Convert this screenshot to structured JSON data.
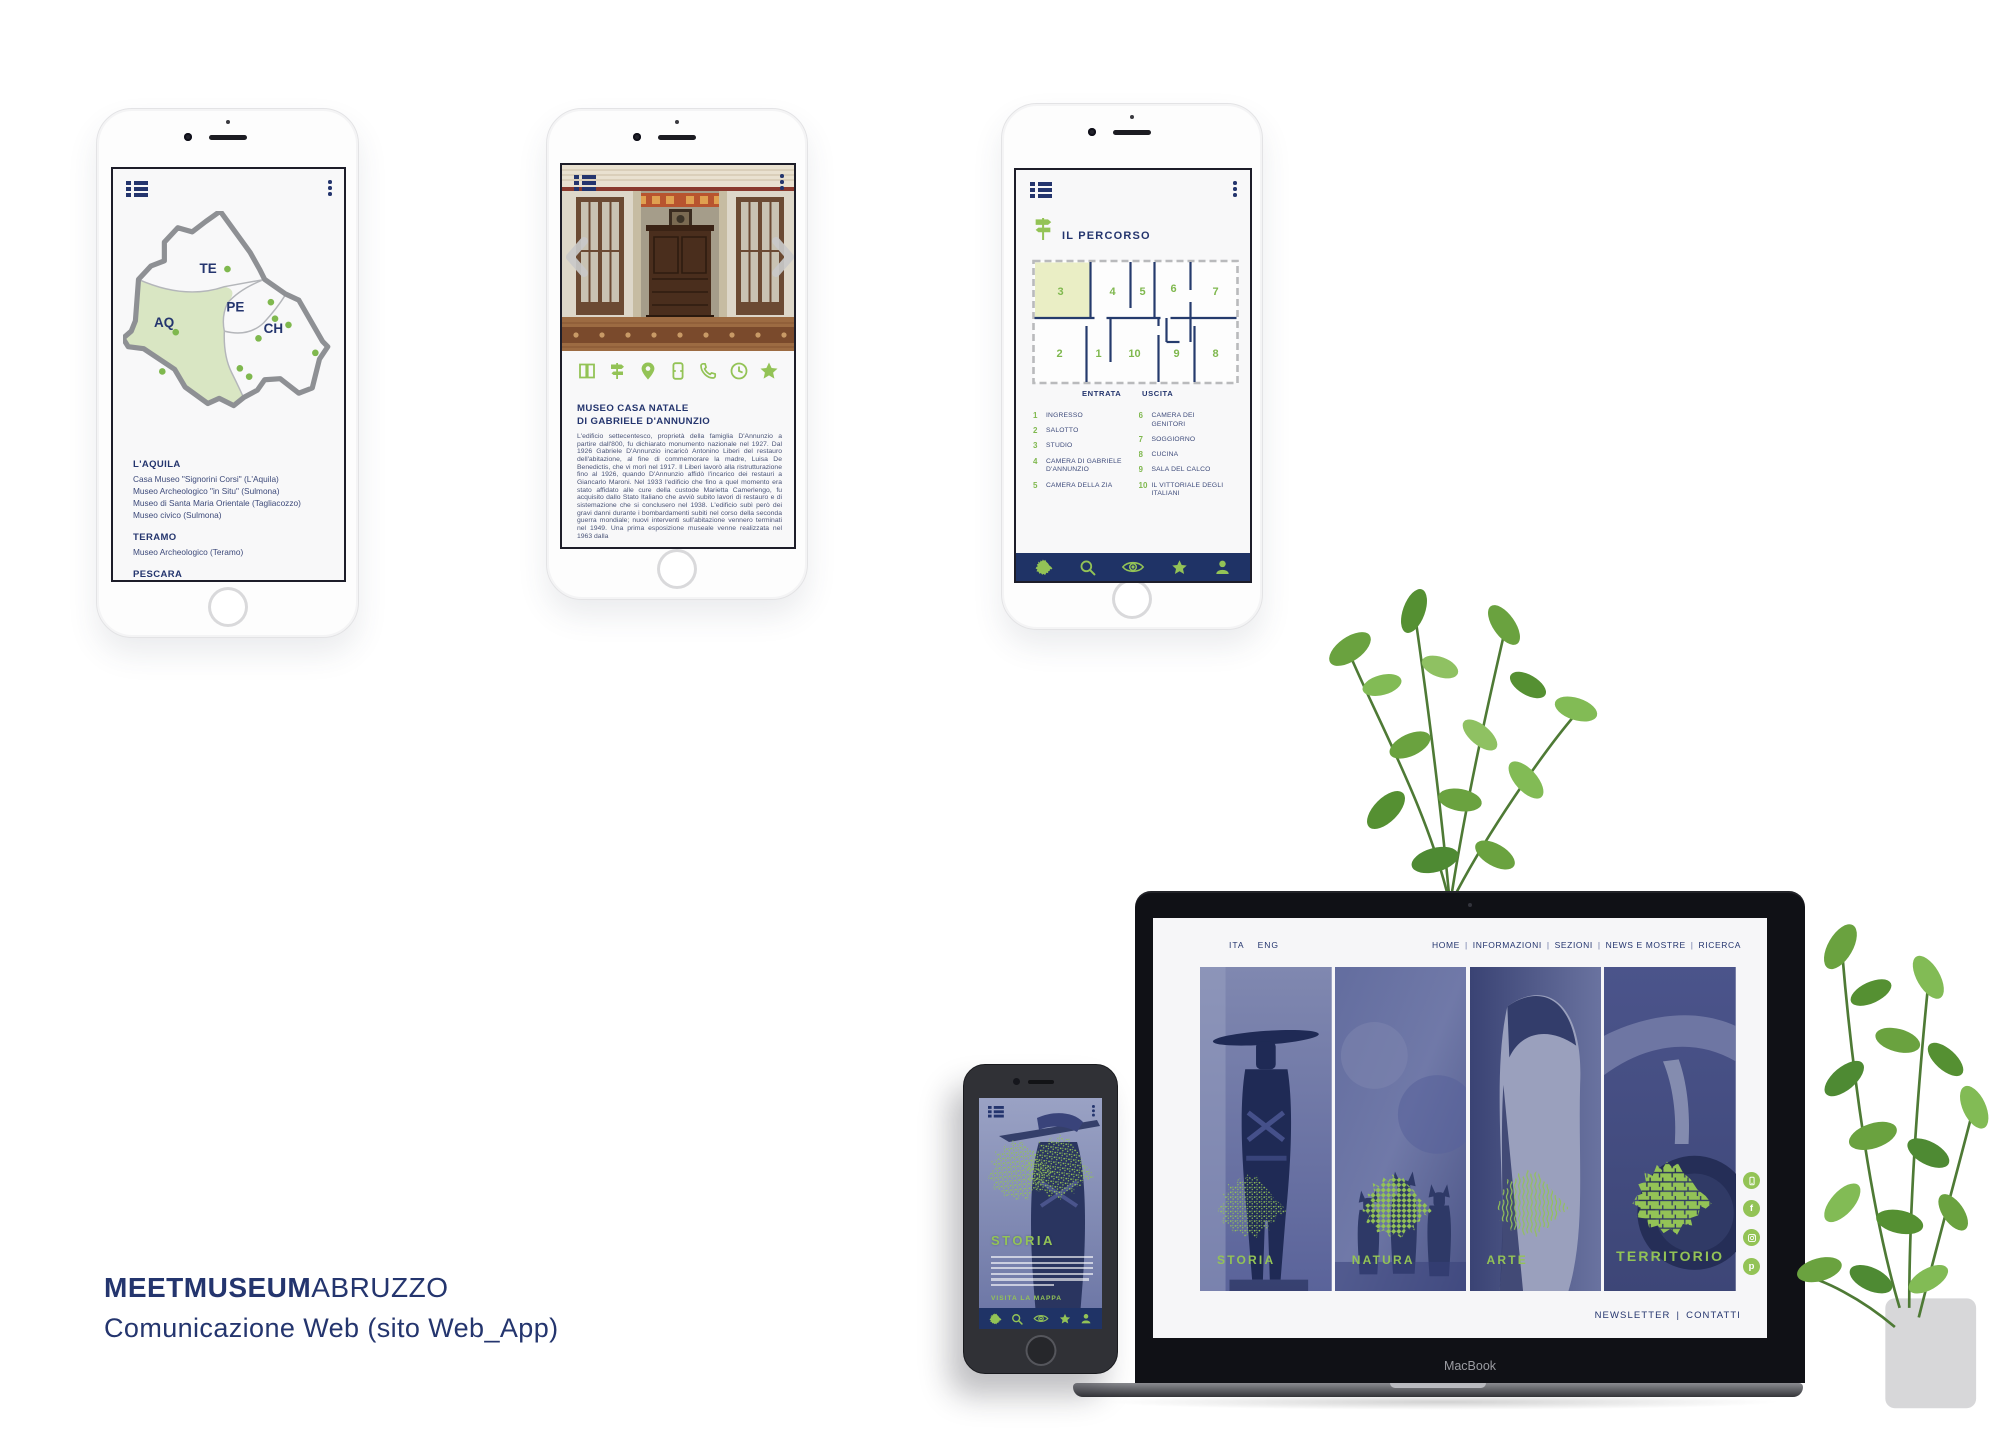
{
  "caption": {
    "brand_bold": "MEETMUSEUM",
    "brand_light": "ABRUZZO",
    "subtitle": "Comunicazione Web (sito Web_App)"
  },
  "colors": {
    "navy": "#24356e",
    "green": "#93c356",
    "map_fill": "#d9e6c3",
    "room_highlight": "#eaeec5",
    "duotone_blue": "#4c5587"
  },
  "app_map_screen": {
    "provinces": [
      {
        "code": "TE"
      },
      {
        "code": "PE"
      },
      {
        "code": "AQ"
      },
      {
        "code": "CH"
      }
    ],
    "sections": [
      {
        "heading": "L'AQUILA",
        "items": [
          "Casa Museo \"Signorini Corsi\" (L'Aquila)",
          "Museo Archeologico \"in Situ\" (Sulmona)",
          "Museo di Santa Maria Orientale (Tagliacozzo)",
          "Museo civico (Sulmona)"
        ]
      },
      {
        "heading": "TERAMO",
        "items": [
          "Museo Archeologico (Teramo)"
        ]
      },
      {
        "heading": "PESCARA",
        "items": [
          "Museo Casa Natale di Gabriele D'Annunzio (Pescara)",
          "Museo delle Ambre e dei Fossili (S. Valentino)"
        ]
      }
    ]
  },
  "app_museum_screen": {
    "title_line1": "MUSEO CASA NATALE",
    "title_line2": "DI GABRIELE D'ANNUNZIO",
    "body": "L'edificio settecentesco, proprietà della famiglia D'Annunzio a partire dall'800, fu dichiarato monumento nazionale nel 1927. Dal 1926 Gabriele D'Annunzio incaricò Antonino Liberi del restauro dell'abitazione, al fine di commemorare la madre, Luisa De Benedictis, che vi morì nel 1917. Il Liberi lavorò alla ristrutturazione fino al 1926, quando D'Annunzio affidò l'incarico dei restauri a Giancarlo Maroni. Nel 1933 l'edificio che fino a quel momento era stato affidato alle cure della custode Marietta Camerlengo, fu acquisito dallo Stato Italiano che avviò subito lavori di restauro e di sistemazione che si conclusero nel 1938. L'edificio subì però dei gravi danni durante i bombardamenti subiti nel corso della seconda guerra mondiale; nuovi interventi sull'abitazione vennero terminati nel 1949. Una prima esposizione museale venne realizzata nel 1963 dalla",
    "action_icons": [
      "book",
      "signpost",
      "location-pin",
      "ticket",
      "phone",
      "clock",
      "star"
    ]
  },
  "app_route_screen": {
    "title": "IL PERCORSO",
    "entrance_label": "ENTRATA",
    "exit_label": "USCITA",
    "plan_numbers": [
      "3",
      "4",
      "5",
      "6",
      "7",
      "2",
      "1",
      "10",
      "9",
      "8"
    ],
    "rooms_left": [
      {
        "n": "1",
        "label": "INGRESSO"
      },
      {
        "n": "2",
        "label": "SALOTTO"
      },
      {
        "n": "3",
        "label": "STUDIO"
      },
      {
        "n": "4",
        "label": "CAMERA DI GABRIELE D'ANNUNZIO"
      },
      {
        "n": "5",
        "label": "CAMERA DELLA ZIA"
      }
    ],
    "rooms_right": [
      {
        "n": "6",
        "label": "CAMERA DEI GENITORI"
      },
      {
        "n": "7",
        "label": "SOGGIORNO"
      },
      {
        "n": "8",
        "label": "CUCINA"
      },
      {
        "n": "9",
        "label": "SALA DEL CALCO"
      },
      {
        "n": "10",
        "label": "IL VITTORIALE DEGLI ITALIANI"
      }
    ],
    "nav_icons": [
      "abruzzo-map",
      "search",
      "eye",
      "star",
      "profile"
    ]
  },
  "website": {
    "languages": [
      "ITA",
      "ENG"
    ],
    "nav": [
      "HOME",
      "INFORMAZIONI",
      "SEZIONI",
      "NEWS E MOSTRE",
      "RICERCA"
    ],
    "separator": "|",
    "sections": [
      {
        "label": "STORIA",
        "pattern": "mosaic-dots"
      },
      {
        "label": "NATURA",
        "pattern": "cross-grid"
      },
      {
        "label": "ARTE",
        "pattern": "brush-lines"
      },
      {
        "label": "TERRITORIO",
        "pattern": "tile-mosaic"
      }
    ],
    "social": [
      "mobile",
      "facebook",
      "instagram",
      "pinterest"
    ],
    "footer": [
      "NEWSLETTER",
      "CONTATTI"
    ],
    "device_label": "MacBook"
  },
  "app_story_screen": {
    "title": "STORIA",
    "link": "VISITA LA MAPPA",
    "nav_icons": [
      "abruzzo-map",
      "search",
      "eye",
      "star",
      "profile"
    ]
  }
}
